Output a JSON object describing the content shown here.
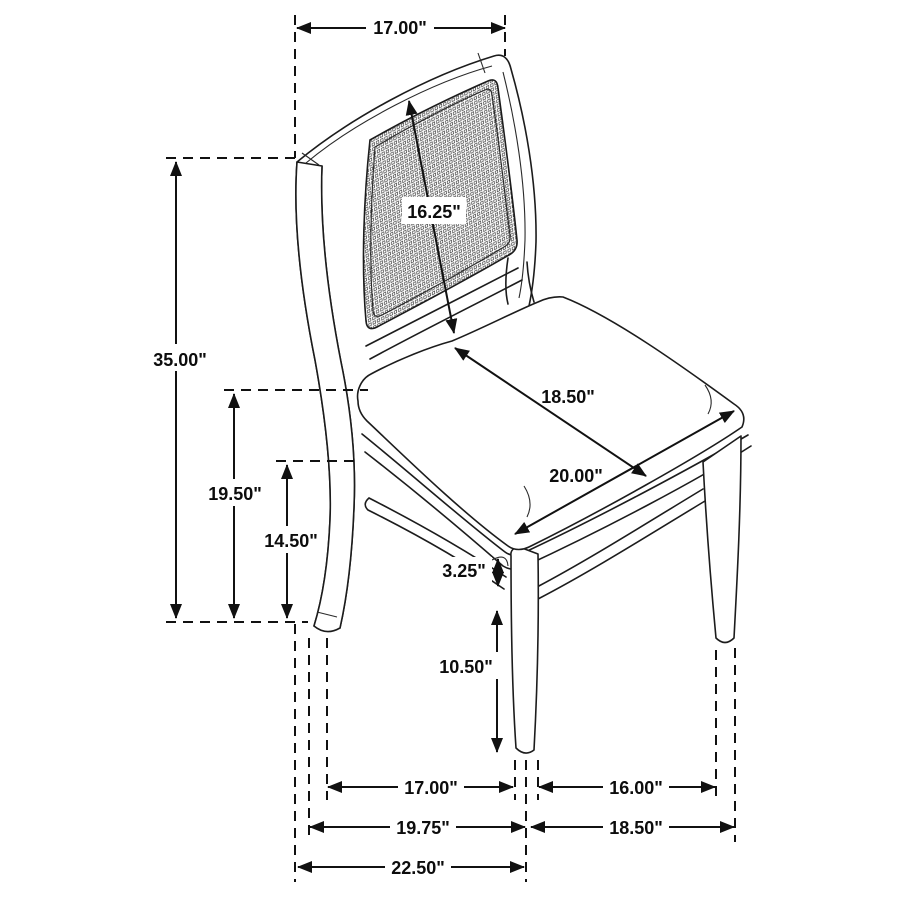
{
  "drawing": {
    "title": "Side chair with cane back - dimension diagram",
    "unit": "inches",
    "line_color": "#1c1c1c",
    "background_color": "#ffffff",
    "label_color": "#0c0c0c"
  },
  "dimensions": {
    "back_width": {
      "label": "17.00\"",
      "value": 17.0,
      "of": "back top width"
    },
    "back_diagonal": {
      "label": "16.25\"",
      "value": 16.25,
      "of": "cane panel diagonal"
    },
    "overall_height": {
      "label": "35.00\"",
      "value": 35.0,
      "of": "overall height"
    },
    "seat_height": {
      "label": "19.50\"",
      "value": 19.5,
      "of": "floor to seat top"
    },
    "floor_to_apron": {
      "label": "14.50\"",
      "value": 14.5,
      "of": "floor to apron"
    },
    "seat_depth": {
      "label": "18.50\"",
      "value": 18.5,
      "of": "seat depth"
    },
    "seat_width": {
      "label": "20.00\"",
      "value": 20.0,
      "of": "seat width"
    },
    "apron_thickness": {
      "label": "3.25\"",
      "value": 3.25,
      "of": "apron to stretcher"
    },
    "leg_height": {
      "label": "10.50\"",
      "value": 10.5,
      "of": "stretcher to floor"
    },
    "base_depth_inner": {
      "label": "17.00\"",
      "value": 17.0,
      "of": "leg spread side inner"
    },
    "base_width_inner": {
      "label": "16.00\"",
      "value": 16.0,
      "of": "leg spread front inner"
    },
    "base_depth_mid": {
      "label": "19.75\"",
      "value": 19.75,
      "of": "leg spread side"
    },
    "base_width_outer": {
      "label": "18.50\"",
      "value": 18.5,
      "of": "leg spread front"
    },
    "base_depth_outer": {
      "label": "22.50\"",
      "value": 22.5,
      "of": "overall depth"
    }
  }
}
